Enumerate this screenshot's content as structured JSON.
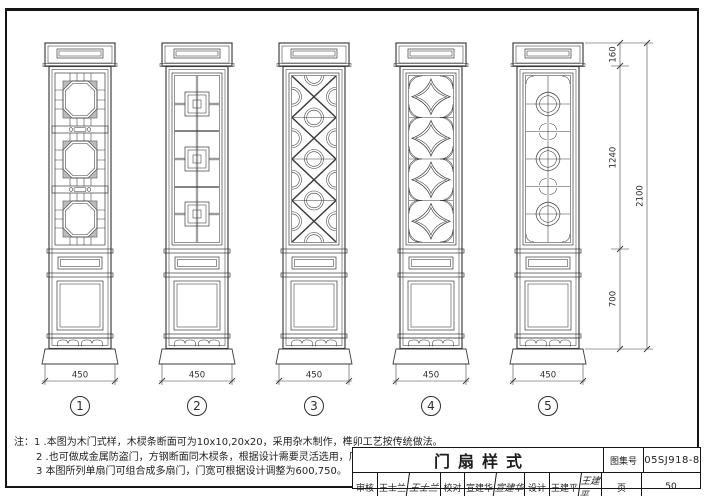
{
  "doors": [
    {
      "no": "1",
      "width_label": "450",
      "pattern": "octagon-ring-lattice"
    },
    {
      "no": "2",
      "width_label": "450",
      "pattern": "nested-square-lattice"
    },
    {
      "no": "3",
      "width_label": "450",
      "pattern": "cross-diagonal-circle-lattice"
    },
    {
      "no": "4",
      "width_label": "450",
      "pattern": "concave-diamond-arc-lattice"
    },
    {
      "no": "5",
      "width_label": "450",
      "pattern": "quatrefoil-grid-lattice"
    }
  ],
  "dims": {
    "top": "160",
    "middle": "1240",
    "bottom": "700",
    "total": "2100"
  },
  "notes": {
    "prefix": "注：",
    "items": [
      "1 .本图为木门式样，木棂条断面可为10x10,20x20，采用杂木制作，榫卯工艺按传统做法。",
      "2 .也可做成金属防盗门，方钢断面同木棂条，根据设计需要灵活选用，厂家定做。",
      "3 本图所列单扇门可组合成多扇门，门宽可根据设计调整为600,750。"
    ]
  },
  "title_block": {
    "title": "门扇样式",
    "atlas_label": "图集号",
    "atlas_no": "05SJ918-8",
    "page_label": "页",
    "page_no": "50",
    "review_label": "审核",
    "reviewer": "王士兰",
    "review_sig": "王士兰",
    "check_label": "校对",
    "checker": "宣建华",
    "check_sig": "宣建华",
    "design_label": "设计",
    "designer": "王建平",
    "design_sig": "王建平"
  }
}
